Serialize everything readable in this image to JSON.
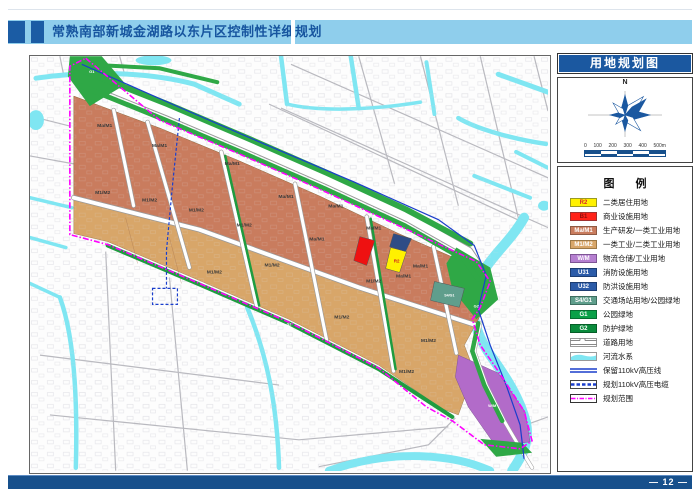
{
  "header": {
    "title": "常熟南部新城金湖路以东片区控制性详细规划"
  },
  "sidebar": {
    "map_title": "用地规划图",
    "compass_label": "N",
    "scale": {
      "labels": [
        "0",
        "100",
        "200",
        "300",
        "400",
        "500m"
      ]
    },
    "legend": {
      "title": "图  例",
      "items": [
        {
          "code": "R2",
          "label": "二类居住用地",
          "swatch": "box",
          "bg": "#FFF100",
          "fg": "#D8262D",
          "border": "#9a9a22"
        },
        {
          "code": "B1",
          "label": "商业设施用地",
          "swatch": "box",
          "bg": "#FF2219",
          "fg": "#8F0E0E",
          "border": "#a03030"
        },
        {
          "code": "Ma/M1",
          "label": "生产研发/一类工业用地",
          "swatch": "box",
          "bg": "#C97C5E",
          "fg": "#FFFFFF",
          "border": "#8f5a44"
        },
        {
          "code": "M1/M2",
          "label": "一类工业/二类工业用地",
          "swatch": "box",
          "bg": "#D8A669",
          "fg": "#FFFFFF",
          "border": "#9c7846"
        },
        {
          "code": "W/M",
          "label": "物流仓储/工业用地",
          "swatch": "box",
          "bg": "#B57FD0",
          "fg": "#FFFFFF",
          "border": "#7e5595"
        },
        {
          "code": "U31",
          "label": "消防设施用地",
          "swatch": "box",
          "bg": "#2B5BA8",
          "fg": "#FFFFFF",
          "border": "#1c3d72"
        },
        {
          "code": "U32",
          "label": "防洪设施用地",
          "swatch": "box",
          "bg": "#2B5BA8",
          "fg": "#FFFFFF",
          "border": "#1c3d72"
        },
        {
          "code": "S4/G1",
          "label": "交通场站用地/公园绿地",
          "swatch": "box",
          "bg": "#5F9E8C",
          "fg": "#FFFFFF",
          "border": "#3e6e60"
        },
        {
          "code": "G1",
          "label": "公园绿地",
          "swatch": "box",
          "bg": "#0AA048",
          "fg": "#FFFFFF",
          "border": "#076d31"
        },
        {
          "code": "G2",
          "label": "防护绿地",
          "swatch": "box",
          "bg": "#0A8B3C",
          "fg": "#FFFFFF",
          "border": "#065e28"
        },
        {
          "code": "",
          "label": "道路用地",
          "swatch": "road"
        },
        {
          "code": "",
          "label": "河流水系",
          "swatch": "water",
          "bg": "#7FE6F2"
        },
        {
          "code": "",
          "label": "保留110kV高压线",
          "swatch": "line-double",
          "bg": "#1A3ECC"
        },
        {
          "code": "",
          "label": "规划110kV高压电缆",
          "swatch": "line-dashed",
          "bg": "#1A3ECC"
        },
        {
          "code": "",
          "label": "规划范围",
          "swatch": "boundary",
          "bg": "#FF00FF"
        }
      ]
    }
  },
  "map": {
    "labels": [
      {
        "t": "Ma/M1",
        "x": 75,
        "y": 71
      },
      {
        "t": "Ma/M1",
        "x": 130,
        "y": 91
      },
      {
        "t": "Ma/M1",
        "x": 203,
        "y": 109
      },
      {
        "t": "Ma/M1",
        "x": 257,
        "y": 142
      },
      {
        "t": "Ma/M1",
        "x": 307,
        "y": 152
      },
      {
        "t": "Ma/M1",
        "x": 345,
        "y": 174
      },
      {
        "t": "Ma/M1",
        "x": 288,
        "y": 185
      },
      {
        "t": "Ma/M1",
        "x": 392,
        "y": 212
      },
      {
        "t": "Ma/M1",
        "x": 375,
        "y": 222
      },
      {
        "t": "M1/M2",
        "x": 73,
        "y": 138
      },
      {
        "t": "M1/M2",
        "x": 120,
        "y": 146
      },
      {
        "t": "M1/M2",
        "x": 167,
        "y": 156
      },
      {
        "t": "M1/M2",
        "x": 215,
        "y": 171
      },
      {
        "t": "M1/M2",
        "x": 185,
        "y": 218
      },
      {
        "t": "M1/M2",
        "x": 243,
        "y": 211
      },
      {
        "t": "M1/M2",
        "x": 313,
        "y": 263
      },
      {
        "t": "M1/M2",
        "x": 345,
        "y": 227
      },
      {
        "t": "M1/M2",
        "x": 400,
        "y": 287
      },
      {
        "t": "M1/M2",
        "x": 378,
        "y": 318
      },
      {
        "t": "R2",
        "x": 368,
        "y": 207,
        "c": "#D02020",
        "s": 4.5
      },
      {
        "t": "S4/G1",
        "x": 421,
        "y": 241,
        "c": "#ffffff",
        "s": 3.6
      },
      {
        "t": "W/M",
        "x": 464,
        "y": 352,
        "c": "#ffffff",
        "s": 4
      },
      {
        "t": "G1",
        "x": 62,
        "y": 17,
        "c": "#ffffff",
        "s": 4
      },
      {
        "t": "G2",
        "x": 448,
        "y": 252,
        "c": "#ffffff",
        "s": 4
      },
      {
        "t": "G2",
        "x": 260,
        "y": 270,
        "c": "#ffffff",
        "s": 3.5
      }
    ]
  },
  "footer": {
    "page_number": "— 12 —"
  },
  "colors": {
    "header_bar": "#8FCEEC",
    "footer_bar": "#17508C",
    "boundary": "#FF00FF",
    "water": "#7FE6F2",
    "power_line": "#1A3ECC",
    "industry_1": "#C97C5E",
    "industry_2": "#D8A669",
    "park_green": "#2FA846"
  }
}
